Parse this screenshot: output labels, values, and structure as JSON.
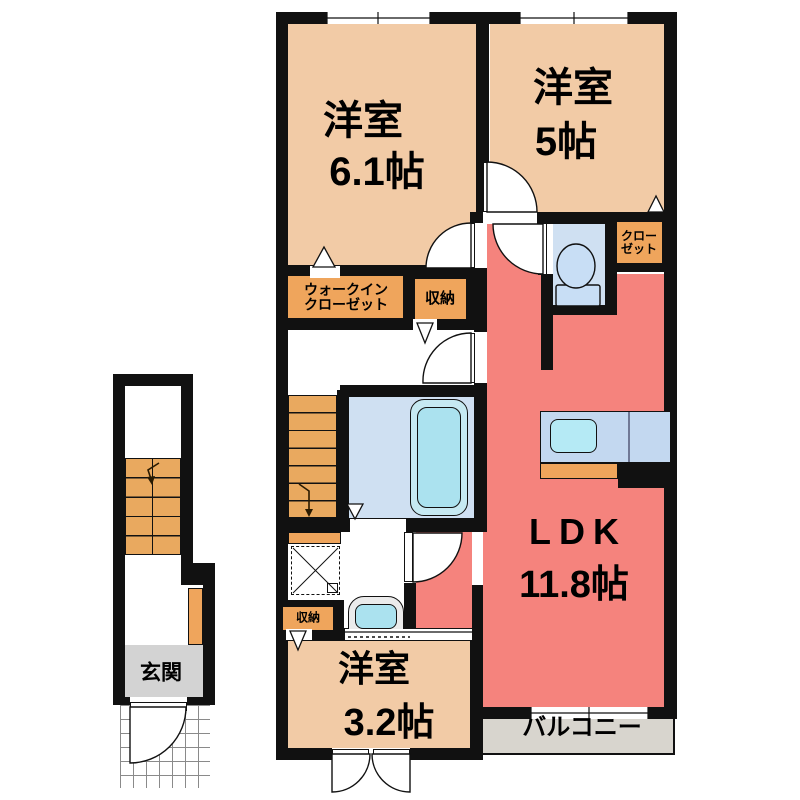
{
  "colors": {
    "wall": "#111111",
    "room_beige": "#F2CBA6",
    "ldk_salmon": "#F5837D",
    "closet_orange": "#EFA55C",
    "stairs_orange": "#E9A95F",
    "wet_blue": "#CFE0F2",
    "fixture_fill": "#ABE2EF",
    "fixture_light": "#C6E9F2",
    "kitchen_counter": "#C3D8F0",
    "kitchen_sink": "#B5EAF5",
    "toilet_fill": "#C8DEF5",
    "balcony_gray": "#D8D5CE",
    "entrance_gray": "#D3D3D3",
    "vanity_gray": "#EBEBEB"
  },
  "labels": {
    "bedroom1": {
      "name": "洋室",
      "size": "6.1帖"
    },
    "bedroom2": {
      "name": "洋室",
      "size": "5帖"
    },
    "ldk": {
      "name": "LDK",
      "size": "11.8帖"
    },
    "bedroom3": {
      "name": "洋室",
      "size": "3.2帖"
    },
    "walk_in_closet": {
      "line1": "ウォークイン",
      "line2": "クローゼット"
    },
    "closet": {
      "line1": "クロー",
      "line2": "ゼット"
    },
    "storage_upper": "収納",
    "storage_lower": "収納",
    "balcony": "バルコニー",
    "entrance": "玄関"
  }
}
